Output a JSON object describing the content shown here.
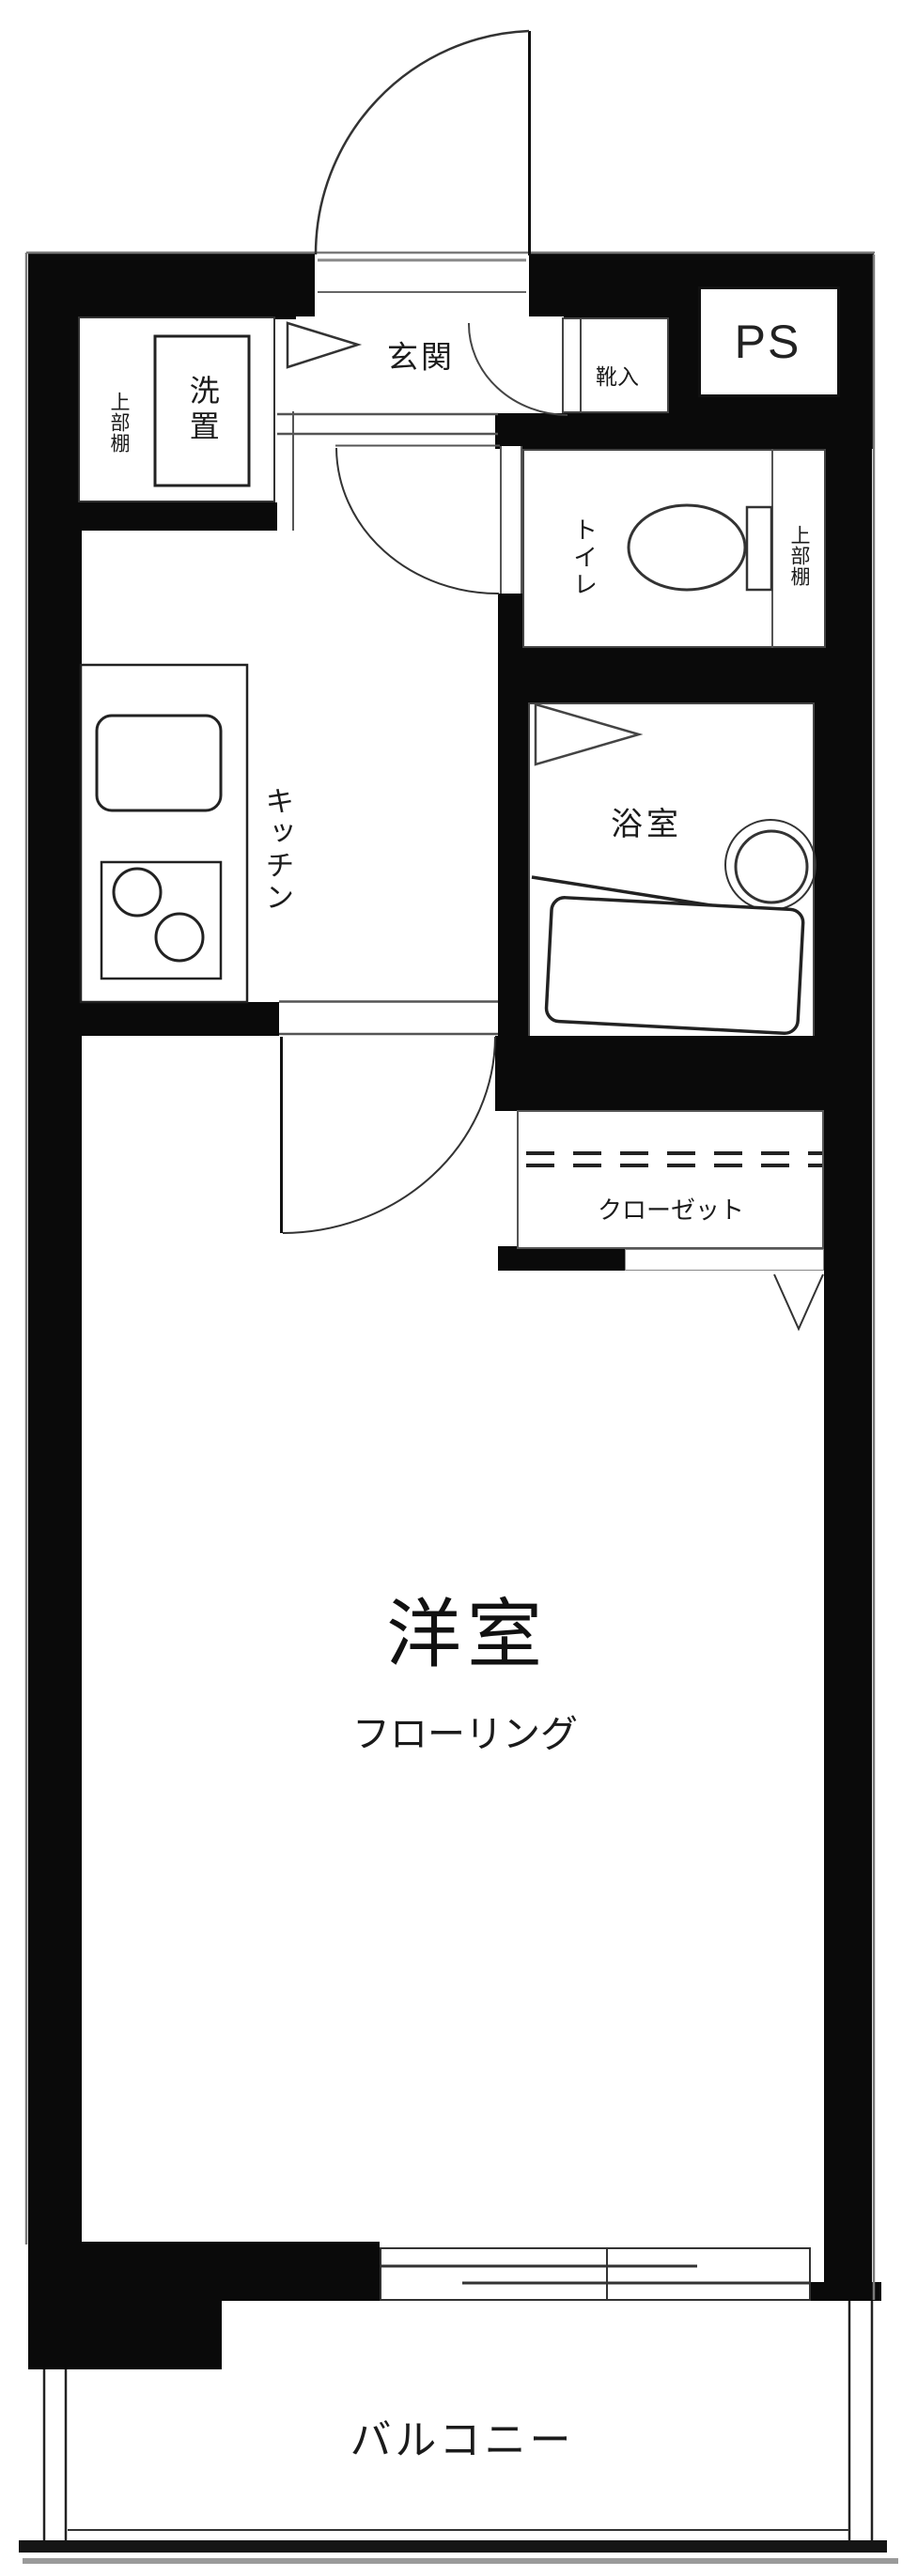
{
  "plan_type": "floor-plan",
  "labels": {
    "entrance": "玄関",
    "shoe_cabinet": "靴入",
    "pipe_space": "PS",
    "toilet": "トイレ",
    "toilet_upper_shelf": "上部棚",
    "laundry_upper_shelf": "上部棚",
    "washer_space": "洗置",
    "kitchen": "キッチン",
    "bathroom": "浴室",
    "closet": "クローゼット",
    "main_room": "洋室",
    "flooring": "フローリング",
    "balcony": "バルコニー"
  },
  "colors": {
    "wall": "#0a0a0a",
    "line": "#3c3c3c",
    "thin_line": "#777777",
    "text": "#1b1b1b",
    "background": "#ffffff"
  }
}
